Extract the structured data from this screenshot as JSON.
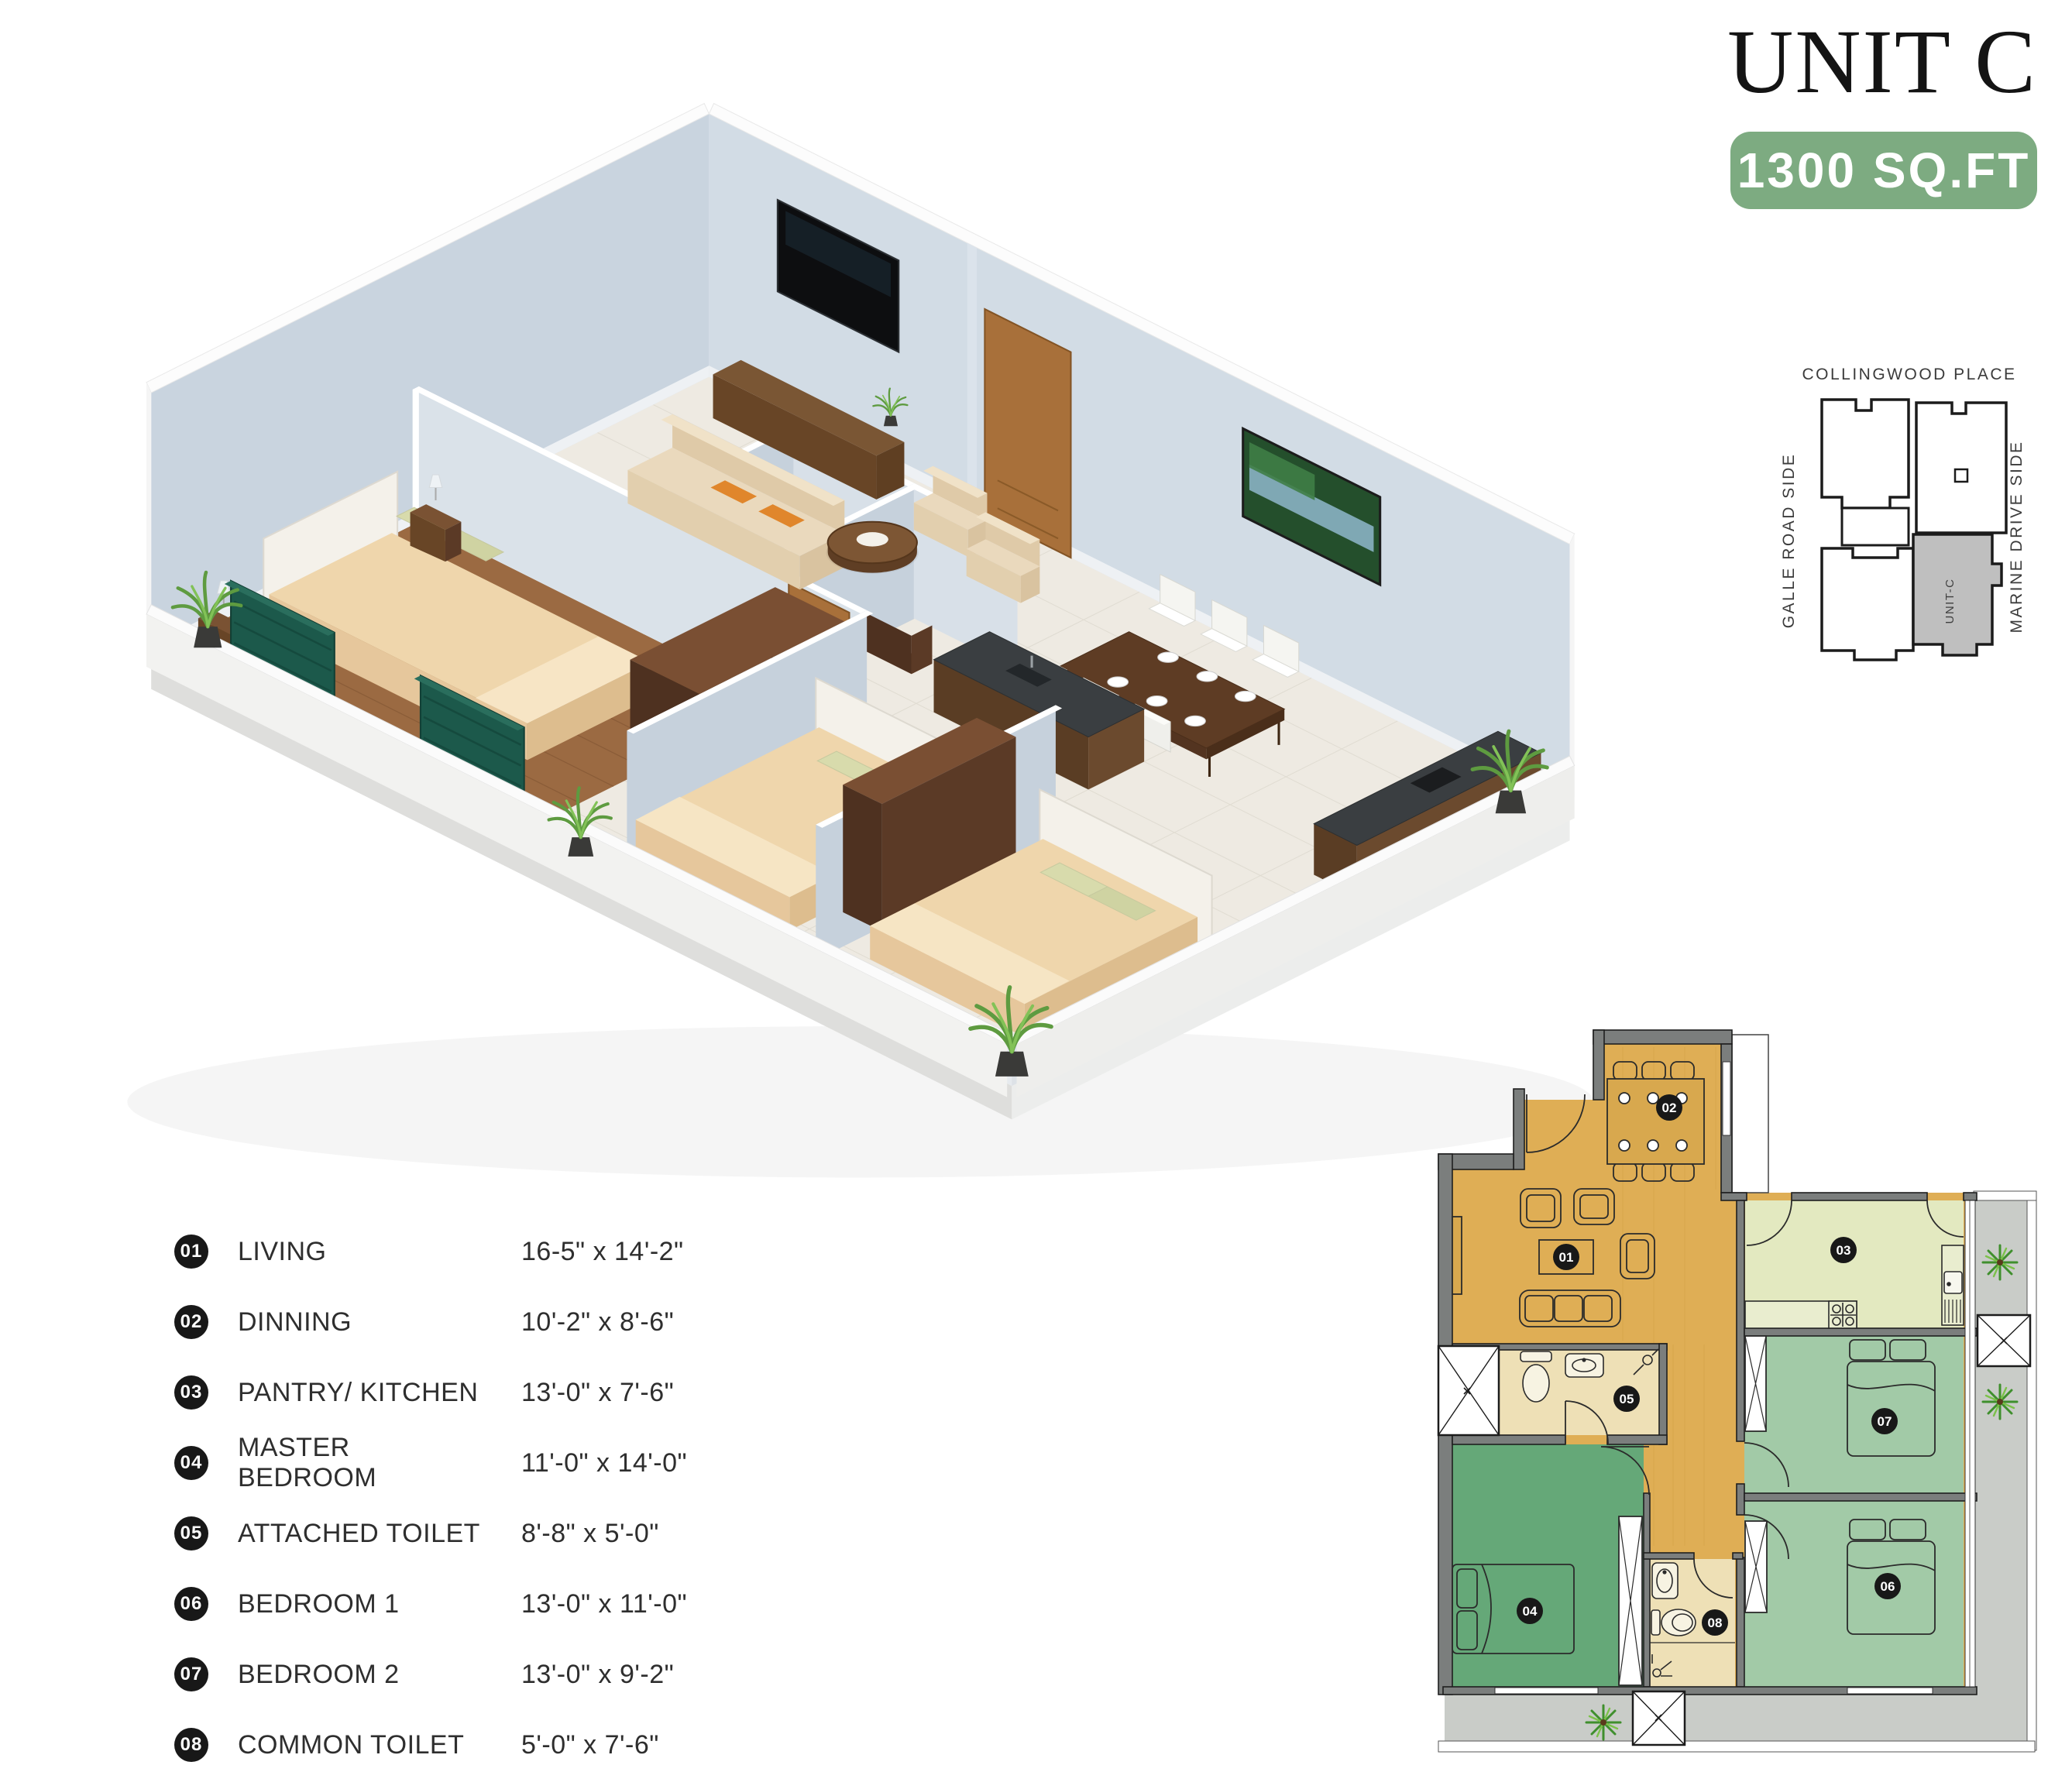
{
  "header": {
    "title": "UNIT C",
    "area_badge": "1300 SQ.FT"
  },
  "locator": {
    "top_label": "COLLINGWOOD PLACE",
    "left_label": "GALLE ROAD SIDE",
    "right_label": "MARINE DRIVE SIDE",
    "unit_label": "UNIT-C"
  },
  "legend": {
    "items": [
      {
        "num": "01",
        "label": "LIVING",
        "dims": "16-5\" x 14'-2\""
      },
      {
        "num": "02",
        "label": "DINNING",
        "dims": "10'-2\" x 8'-6\""
      },
      {
        "num": "03",
        "label": "PANTRY/ KITCHEN",
        "dims": "13'-0\" x 7'-6\""
      },
      {
        "num": "04",
        "label": "MASTER BEDROOM",
        "dims": "11'-0\" x 14'-0\""
      },
      {
        "num": "05",
        "label": "ATTACHED TOILET",
        "dims": "8'-8\" x 5'-0\""
      },
      {
        "num": "06",
        "label": "BEDROOM  1",
        "dims": "13'-0\" x 11'-0\""
      },
      {
        "num": "07",
        "label": "BEDROOM  2",
        "dims": "13'-0\" x 9'-2\""
      },
      {
        "num": "08",
        "label": "COMMON TOILET",
        "dims": "5'-0\" x 7'-6\""
      }
    ]
  },
  "plan2d": {
    "labels": [
      "01",
      "02",
      "03",
      "04",
      "05",
      "06",
      "07",
      "08"
    ]
  },
  "colors": {
    "badge_green": "#7dab81",
    "living_orange": "#dfae55",
    "kitchen_green": "#e3e9c0",
    "bedroom_green": "#a2caa7",
    "master_green": "#65a878",
    "toilet_cream": "#eee0b6",
    "wall_gray": "#7b7e7d",
    "terrace_gray": "#c9ccc8"
  }
}
